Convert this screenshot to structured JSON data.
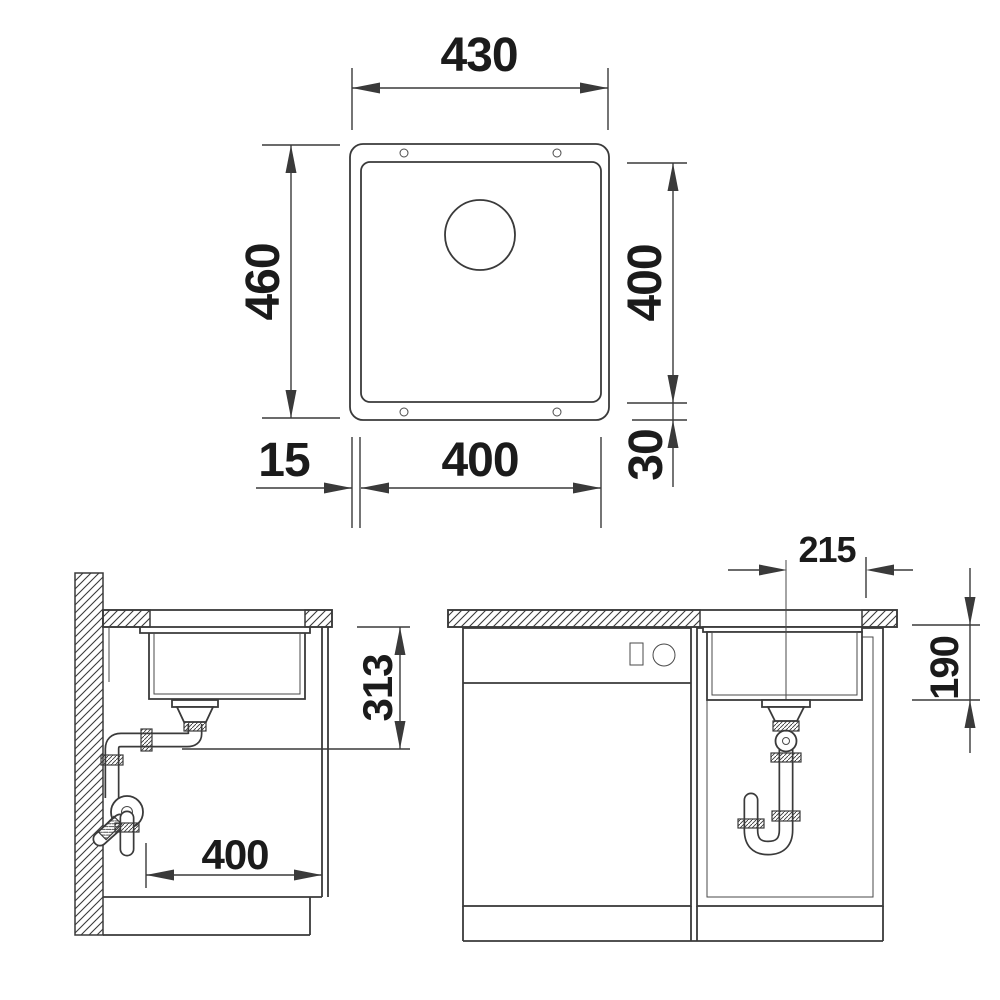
{
  "dims": {
    "top_view": {
      "overall_width": "430",
      "overall_height": "460",
      "bowl_height": "400",
      "rim_bottom": "30",
      "rim_left": "15",
      "bowl_width": "400"
    },
    "side_view": {
      "drain_height": "313",
      "base_width": "400"
    },
    "front_view": {
      "center_to_edge": "215",
      "bowl_depth": "190"
    }
  },
  "colors": {
    "line": "#3a3a3a",
    "label": "#1b1b1b",
    "background": "#ffffff"
  }
}
